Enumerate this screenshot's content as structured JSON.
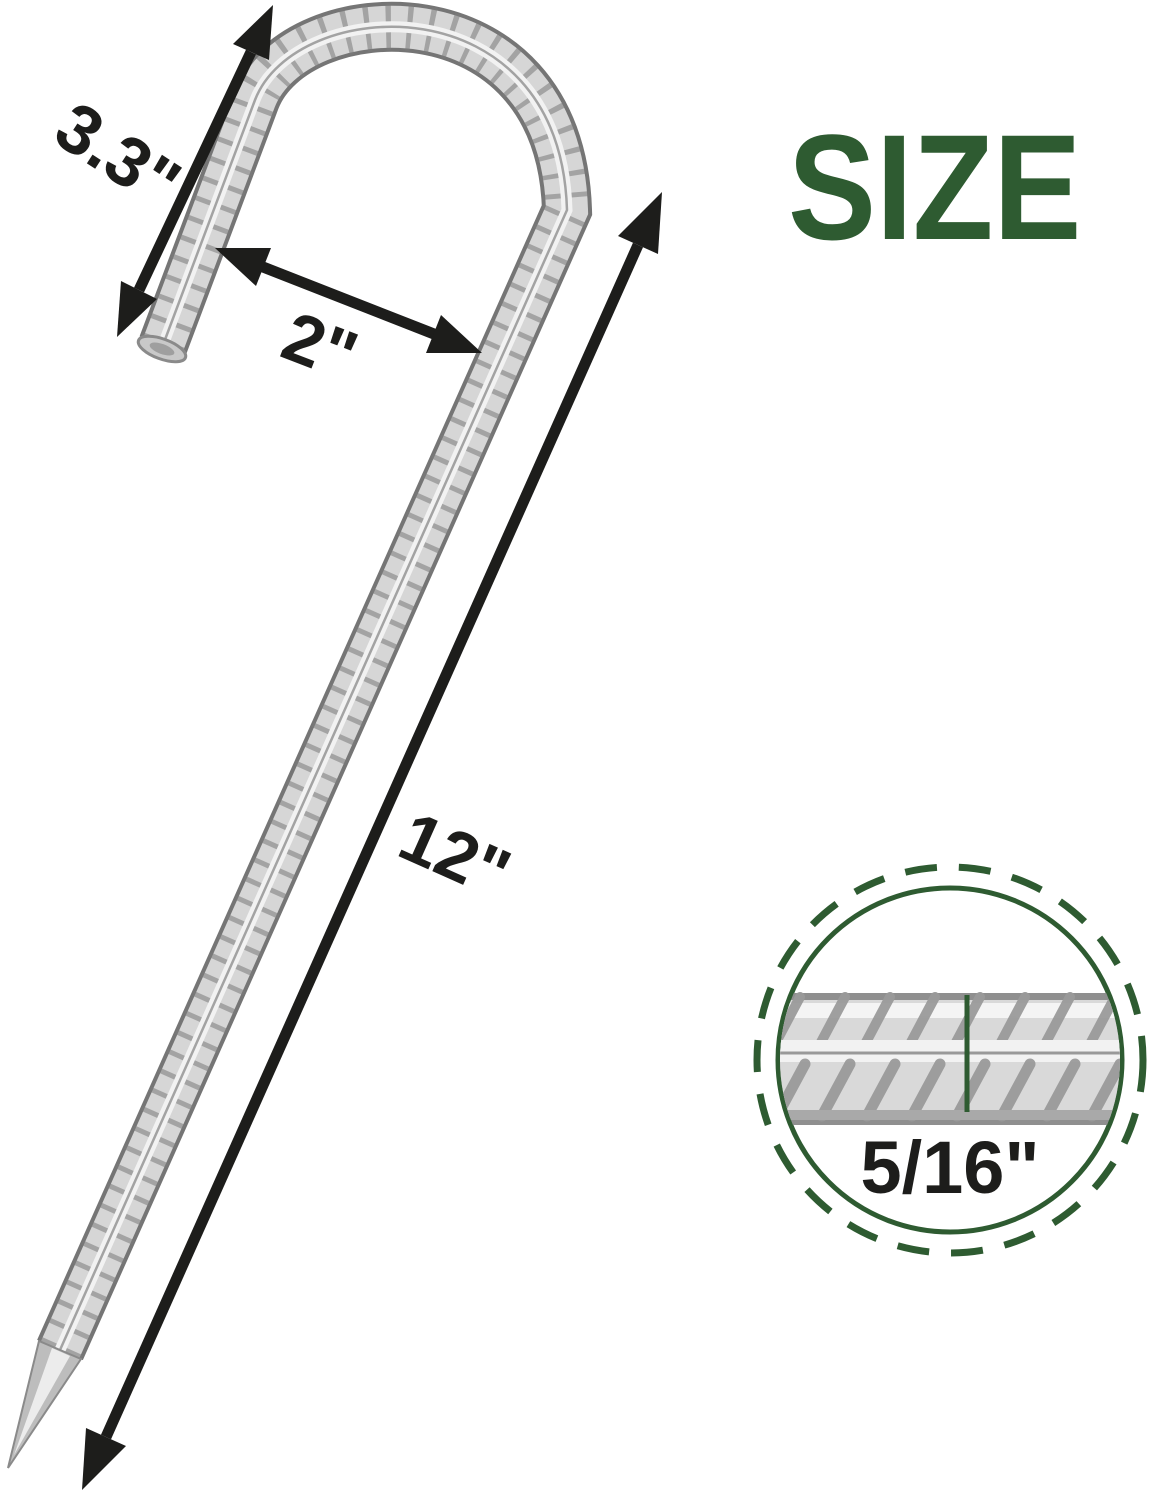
{
  "page": {
    "background_color": "#ffffff",
    "title": "SIZE",
    "title_color": "#2e5b31"
  },
  "diagram": {
    "line_color": "#1d1d1b",
    "accent_green": "#2e5b31",
    "metal_light": "#d6d6d6",
    "metal_dark": "#757575",
    "dimensions": {
      "hook_length": "3.3\"",
      "hook_inner_width": "2\"",
      "stake_length": "12\"",
      "diameter": "5/16\""
    }
  }
}
